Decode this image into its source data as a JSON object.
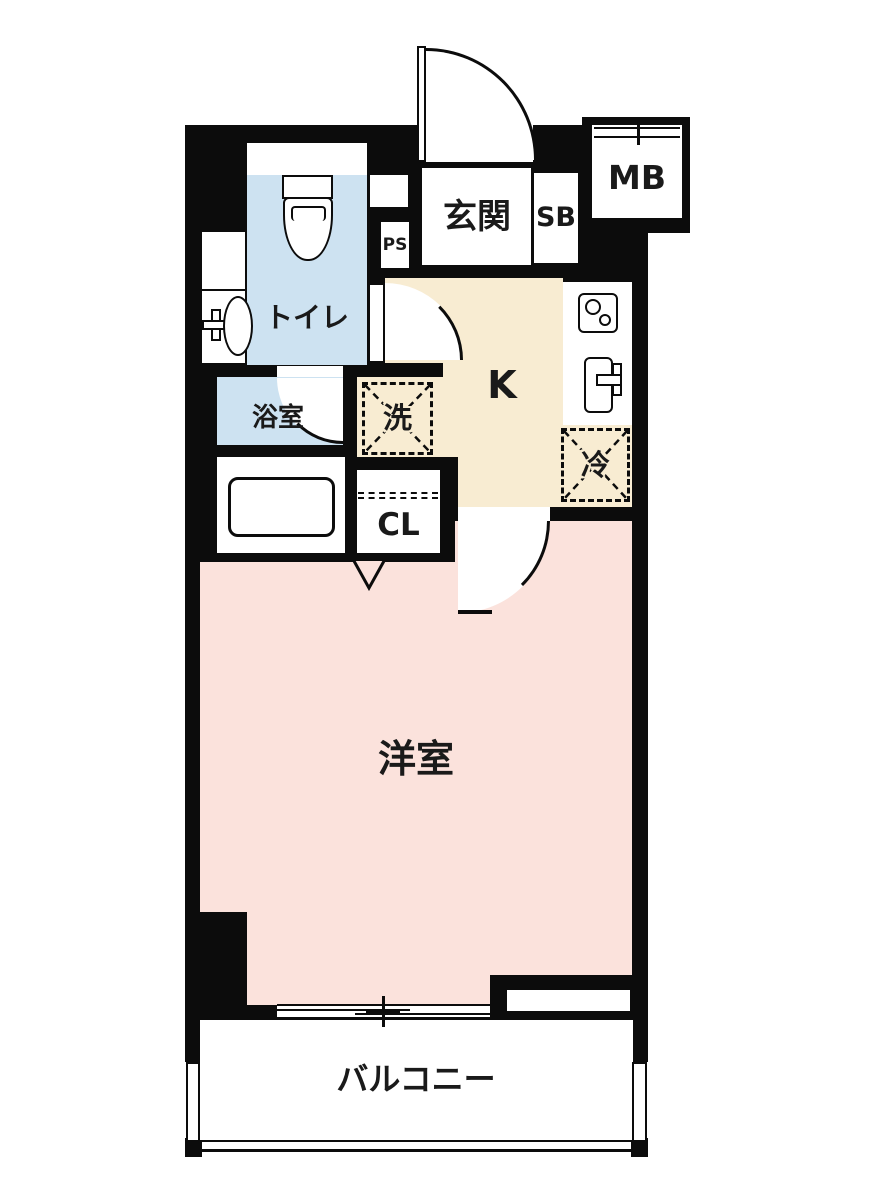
{
  "floorplan": {
    "type": "apartment-floor-plan",
    "rooms": {
      "entrance": {
        "label": "玄関"
      },
      "shoe_box": {
        "label": "SB"
      },
      "meter_box": {
        "label": "MB"
      },
      "pipe_space": {
        "label": "PS"
      },
      "toilet": {
        "label": "トイレ"
      },
      "bathroom": {
        "label": "浴室"
      },
      "laundry": {
        "label": "洗"
      },
      "kitchen": {
        "label": "K"
      },
      "refrigerator": {
        "label": "冷"
      },
      "closet": {
        "label": "CL"
      },
      "western_room": {
        "label": "洋室"
      },
      "balcony": {
        "label": "バルコニー"
      }
    },
    "colors": {
      "wall": "#0c0c0c",
      "water_area_floor": "#cde2f1",
      "kitchen_floor": "#f8ecd2",
      "room_floor": "#fbe2dc",
      "background": "#ffffff"
    }
  }
}
